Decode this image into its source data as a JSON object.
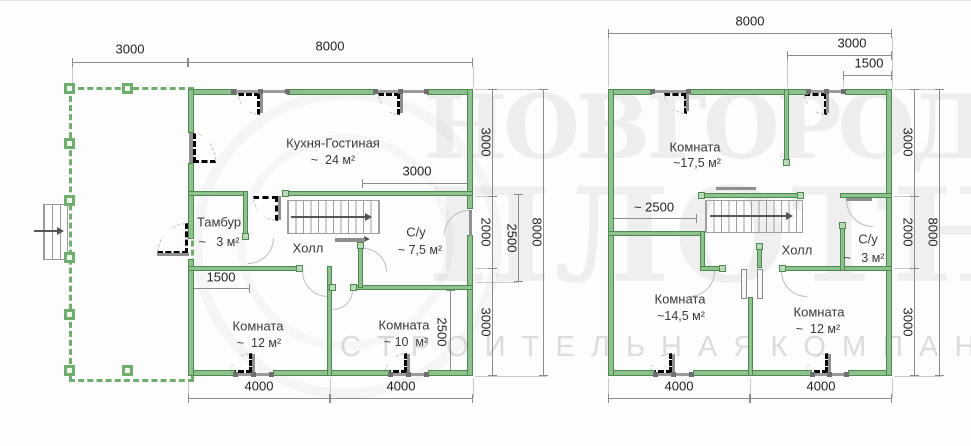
{
  "watermark": {
    "row1": "НОВГОРОДСКИЙ",
    "row2": "ПЛОТНИК",
    "row3": "С Т Р О И Т Е Л Ь Н А Я   К О М П А Н И Я"
  },
  "colors": {
    "wall_green": "#8fc08f",
    "wall_edge": "#4d8a4d",
    "dim_line": "#8c8c8c",
    "dim_text": "#1f1f1f",
    "room_text": "#3a3a3a",
    "watermark_gray": "#dcdcdc"
  },
  "floor1": {
    "rooms": {
      "kitchen": {
        "name": "Кухня-Гостиная",
        "area": "~  24 м²"
      },
      "tambour": {
        "name": "Тамбур",
        "area": "~   3 м²"
      },
      "hall": {
        "name": "Холл"
      },
      "wc": {
        "name": "С/у",
        "area": "~ 7,5 м²"
      },
      "room_left": {
        "name": "Комната",
        "area": "~  12 м²"
      },
      "room_right": {
        "name": "Комната",
        "area": "~ 10  м²"
      }
    },
    "dims": {
      "top_terrace": "3000",
      "top_total": "8000",
      "inner_kitchen": "3000",
      "inner_tambour": "1500",
      "inner_room_right": "2500",
      "right_top": "3000",
      "right_mid": "2000",
      "right_nested": "2500",
      "right_bottom": "3000",
      "right_total": "8000",
      "bottom_left": "4000",
      "bottom_right": "4000"
    }
  },
  "floor2": {
    "rooms": {
      "room_top": {
        "name": "Комната",
        "area": "~17,5 м²"
      },
      "hall": {
        "name": "Холл"
      },
      "wc": {
        "name": "С/у",
        "area": "~   3 м²"
      },
      "room_left": {
        "name": "Комната",
        "area": "~14,5 м²"
      },
      "room_right": {
        "name": "Комната",
        "area": "~  12 м²"
      }
    },
    "dims": {
      "top_total": "8000",
      "top_right": "3000",
      "top_right_nested": "1500",
      "inner_hall": "~ 2500",
      "right_top": "3000",
      "right_mid": "2000",
      "right_bottom": "3000",
      "right_total": "8000",
      "bottom_left": "4000",
      "bottom_right": "4000"
    }
  }
}
